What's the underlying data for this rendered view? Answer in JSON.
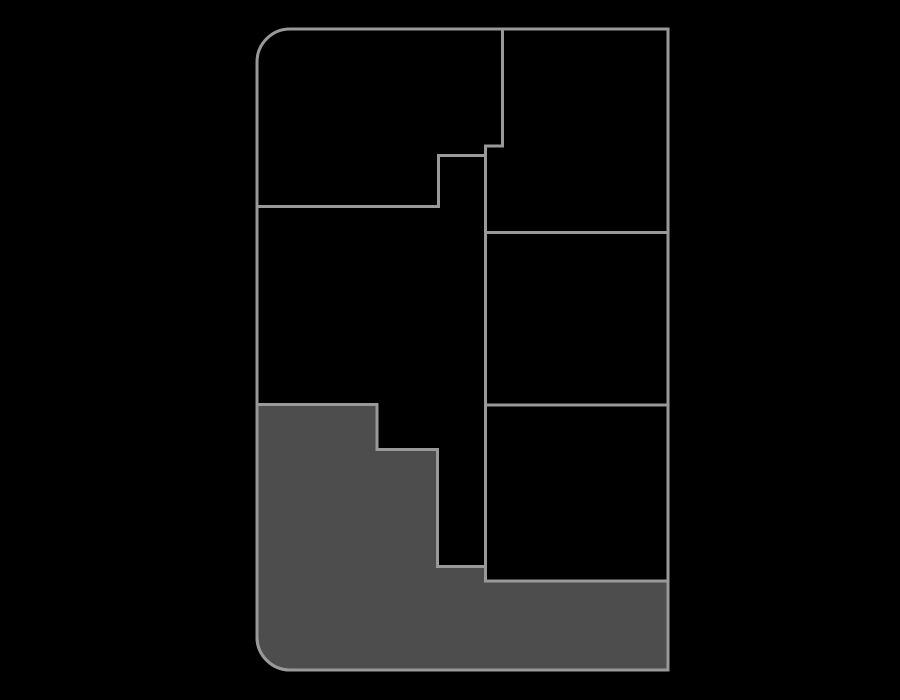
{
  "canvas": {
    "width": 900,
    "height": 700,
    "background": "#000000"
  },
  "palette": {
    "wall_stroke": "#999999",
    "region_fill": "#4d4d4d",
    "stroke_width": 3
  },
  "floorplan": {
    "outer_wall": {
      "name": "outer-wall",
      "d": "M 290 29 H 668 V 670 H 290 A 33 33 0 0 1 257 637 V 62 A 33 33 0 0 1 290 29 Z"
    },
    "interior_walls": [
      {
        "name": "wall-vertical-top-divider",
        "d": "M 502.5 29 V 146 H 485.5 V 581"
      },
      {
        "name": "wall-top-left-room-boundary",
        "d": "M 485.5 155.5 H 438.5 V 206.5 H 257"
      },
      {
        "name": "wall-right-divider-upper",
        "d": "M 485.5 232.5 H 668"
      },
      {
        "name": "wall-right-divider-middle",
        "d": "M 485.5 405 H 668"
      },
      {
        "name": "wall-right-divider-lower",
        "d": "M 485.5 581 H 668"
      }
    ],
    "highlighted_region": {
      "name": "highlighted-region",
      "d": "M 257 404.5 H 377 V 449.5 H 437.5 V 566.5 H 485.5 V 581 H 668 V 670 H 290 A 33 33 0 0 1 257 637 Z"
    }
  }
}
